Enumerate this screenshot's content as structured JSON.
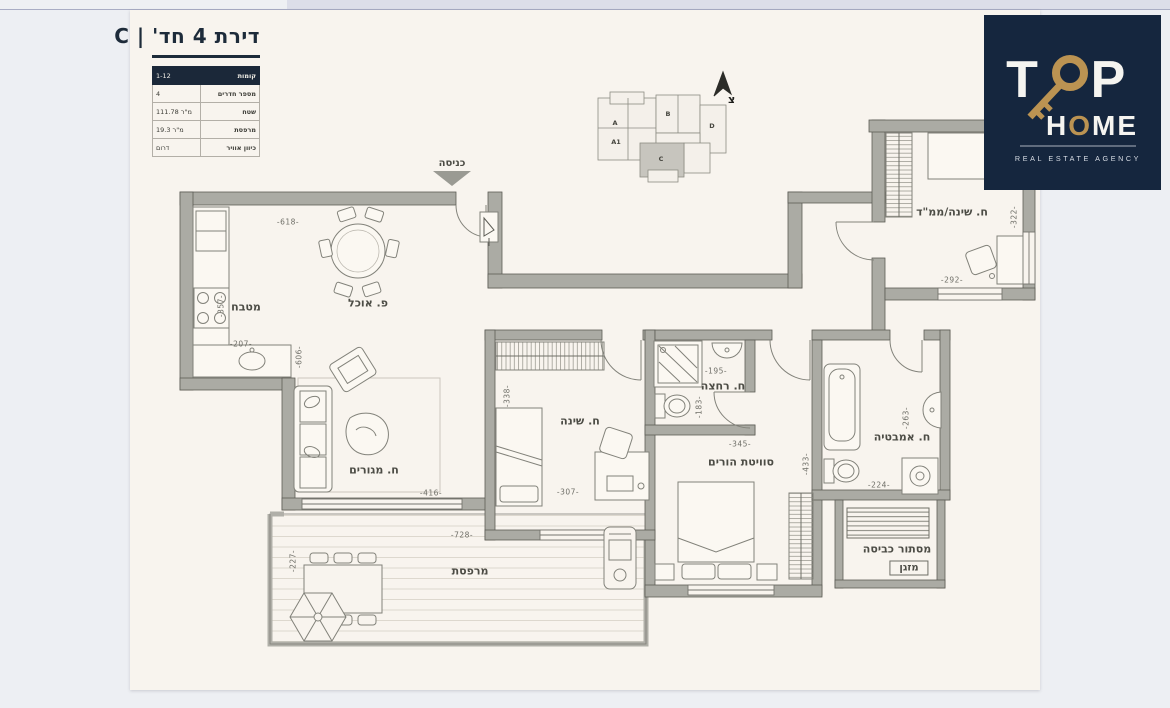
{
  "title_block": {
    "title": "דירת 4 חד' | C",
    "table": [
      {
        "label": "קומות",
        "value": "1-12"
      },
      {
        "label": "מספר חדרים",
        "value": "4"
      },
      {
        "label": "שטח",
        "value": "111.78 מ\"ר"
      },
      {
        "label": "מרפסת",
        "value": "19.3 מ\"ר"
      },
      {
        "label": "כיוון אוויר",
        "value": "דרום"
      }
    ]
  },
  "logo": {
    "t": "T",
    "p": "P",
    "home_h": "H",
    "home_o": "O",
    "home_me": "ME",
    "tagline": "REAL ESTATE AGENCY",
    "bg": "#15263e",
    "gold": "#bb9352"
  },
  "keymap": {
    "north_label": "צ",
    "highlighted_unit": "C",
    "units": [
      {
        "name": "A",
        "x": 615,
        "y": 123
      },
      {
        "name": "A1",
        "x": 616,
        "y": 142
      },
      {
        "name": "B",
        "x": 668,
        "y": 114
      },
      {
        "name": "C",
        "x": 661,
        "y": 159
      },
      {
        "name": "D",
        "x": 712,
        "y": 126
      }
    ]
  },
  "plan": {
    "entrance_label": "כניסה",
    "rooms": [
      {
        "name": "kitchen",
        "label": "מטבח",
        "x": 246,
        "y": 307
      },
      {
        "name": "dining",
        "label": "פ. אוכל",
        "x": 368,
        "y": 303
      },
      {
        "name": "living",
        "label": "ח. מגורים",
        "x": 374,
        "y": 470
      },
      {
        "name": "bedroom",
        "label": "ח. שינה",
        "x": 580,
        "y": 421
      },
      {
        "name": "shower-room",
        "label": "ח. רחצה",
        "x": 723,
        "y": 386
      },
      {
        "name": "master-suite",
        "label": "סוויטת הורים",
        "x": 741,
        "y": 462
      },
      {
        "name": "mamad",
        "label": "ח. שינה/ממ\"ד",
        "x": 952,
        "y": 212
      },
      {
        "name": "bathroom",
        "label": "ח. אמבטיה",
        "x": 902,
        "y": 437
      },
      {
        "name": "laundry",
        "label": "מסתור כביסה",
        "x": 897,
        "y": 549
      },
      {
        "name": "ac",
        "label": "מזגן",
        "x": 909,
        "y": 568,
        "boxed": true
      },
      {
        "name": "balcony",
        "label": "מרפסת",
        "x": 470,
        "y": 571
      }
    ],
    "dimensions": [
      {
        "text": "-618-",
        "x": 288,
        "y": 222,
        "rot": false
      },
      {
        "text": "-357-",
        "x": 221,
        "y": 306,
        "rot": true
      },
      {
        "text": "-207-",
        "x": 241,
        "y": 344,
        "rot": false
      },
      {
        "text": "-606-",
        "x": 299,
        "y": 357,
        "rot": true
      },
      {
        "text": "-416-",
        "x": 431,
        "y": 493,
        "rot": false
      },
      {
        "text": "-338-",
        "x": 507,
        "y": 396,
        "rot": true
      },
      {
        "text": "-307-",
        "x": 568,
        "y": 492,
        "rot": false
      },
      {
        "text": "-195-",
        "x": 716,
        "y": 371,
        "rot": false
      },
      {
        "text": "-183-",
        "x": 699,
        "y": 407,
        "rot": true
      },
      {
        "text": "-345-",
        "x": 740,
        "y": 444,
        "rot": false
      },
      {
        "text": "-433-",
        "x": 806,
        "y": 464,
        "rot": true
      },
      {
        "text": "-263-",
        "x": 906,
        "y": 418,
        "rot": true
      },
      {
        "text": "-224-",
        "x": 879,
        "y": 485,
        "rot": false
      },
      {
        "text": "-322-",
        "x": 1014,
        "y": 217,
        "rot": true
      },
      {
        "text": "-292-",
        "x": 952,
        "y": 280,
        "rot": false
      },
      {
        "text": "-728-",
        "x": 462,
        "y": 535,
        "rot": false
      },
      {
        "text": "-227-",
        "x": 293,
        "y": 561,
        "rot": true
      }
    ]
  },
  "colors": {
    "navy": "#15263e",
    "gold": "#bb9352",
    "wall_gray": "#ababa4",
    "sheet": "#f8f4ee",
    "background": "#edeff3"
  }
}
